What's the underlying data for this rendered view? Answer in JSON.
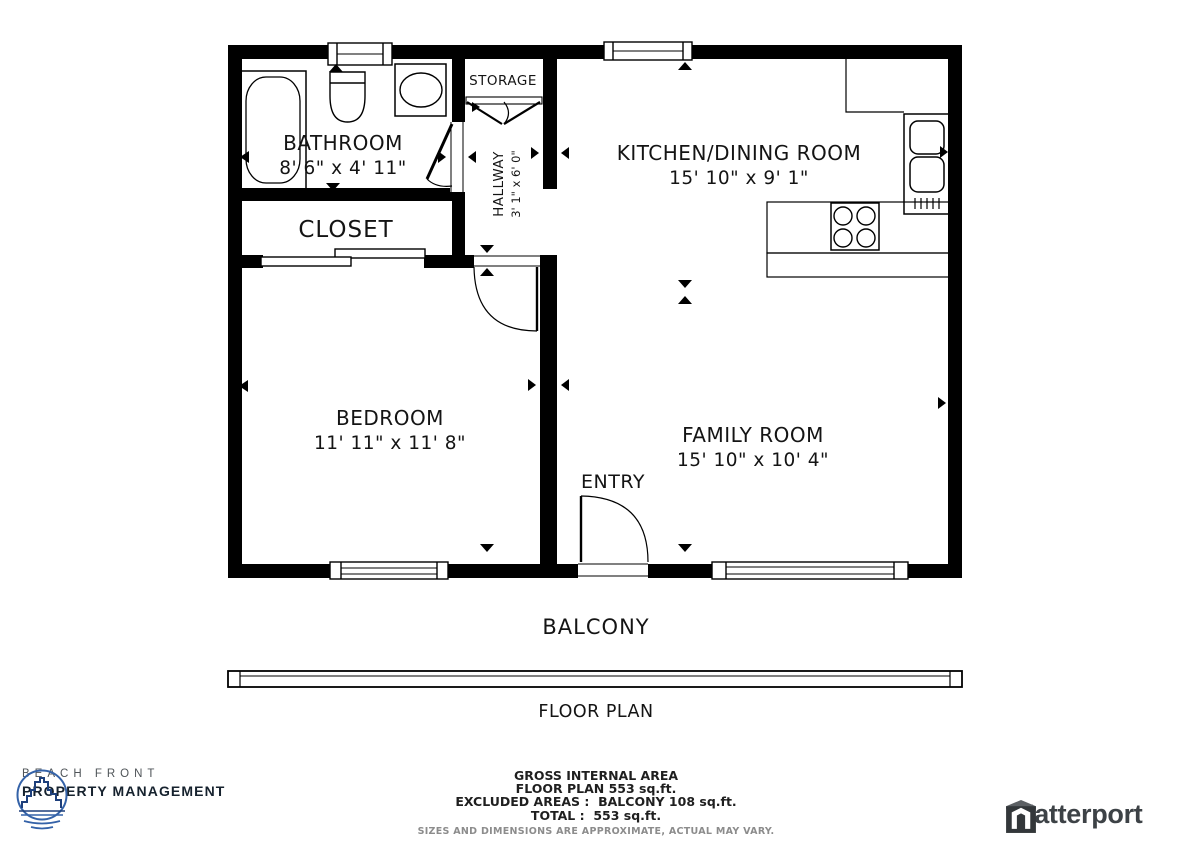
{
  "rooms": {
    "bathroom": {
      "name": "BATHROOM",
      "dims": "8' 6\" x 4' 11\""
    },
    "closet": {
      "name": "CLOSET"
    },
    "storage": {
      "name": "STORAGE"
    },
    "hallway": {
      "name": "HALLWAY",
      "dims": "3' 1\" x 6' 0\""
    },
    "kitchen": {
      "name": "KITCHEN/DINING ROOM",
      "dims": "15' 10\" x 9' 1\""
    },
    "bedroom": {
      "name": "BEDROOM",
      "dims": "11' 11\" x 11' 8\""
    },
    "family": {
      "name": "FAMILY ROOM",
      "dims": "15' 10\" x 10' 4\""
    },
    "entry": {
      "name": "ENTRY"
    },
    "balcony": {
      "name": "BALCONY"
    }
  },
  "plan_title": "FLOOR PLAN",
  "footer": {
    "area_lines": [
      "GROSS INTERNAL AREA",
      "FLOOR PLAN 553 sq.ft.",
      "EXCLUDED AREAS :  BALCONY 108 sq.ft.",
      "TOTAL :  553 sq.ft."
    ],
    "disclaimer": "SIZES AND DIMENSIONS ARE APPROXIMATE, ACTUAL MAY VARY.",
    "brand": {
      "name_top": "BEACH FRONT",
      "name_bottom": "PROPERTY MANAGEMENT"
    },
    "matterport_label": "Matterport"
  },
  "colors": {
    "wall": "#000000",
    "logo_blue": "#3462a8",
    "logo_navy": "#1d3f7b",
    "brand_dark": "#16222e",
    "matterport_gray": "#3d4246"
  }
}
